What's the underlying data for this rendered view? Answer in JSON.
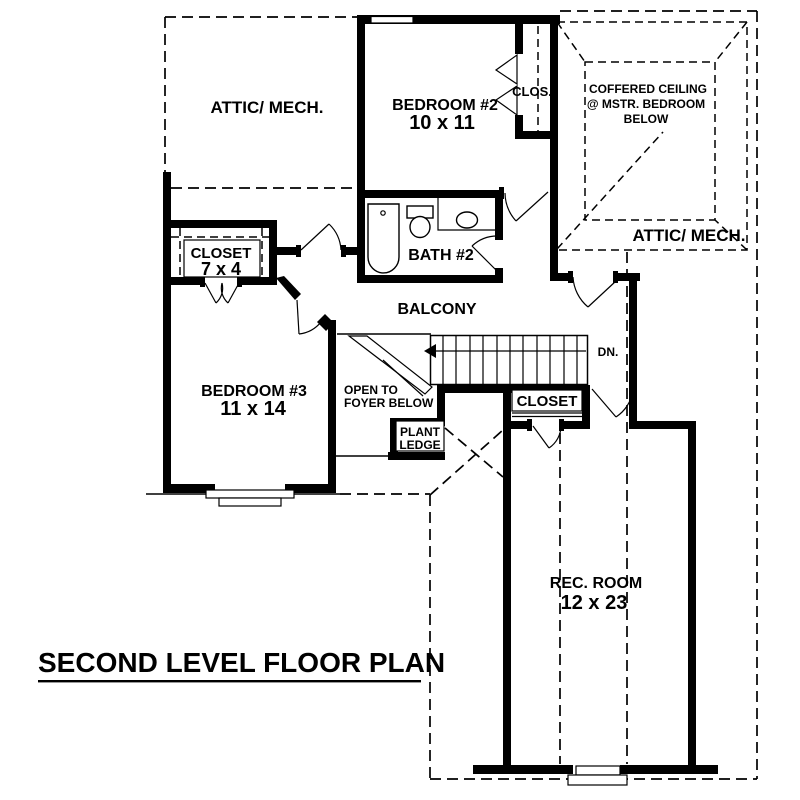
{
  "title": {
    "text": "SECOND LEVEL FLOOR PLAN"
  },
  "labels": {
    "attic_left": "ATTIC/ MECH.",
    "attic_right": "ATTIC/ MECH.",
    "bedroom2_name": "BEDROOM #2",
    "bedroom2_dims": "10 x 11",
    "clos": "CLOS.",
    "coffered_line1": "COFFERED CEILING",
    "coffered_line2": "@ MSTR. BEDROOM",
    "coffered_line3": "BELOW",
    "closet7x4_name": "CLOSET",
    "closet7x4_dims": "7 x 4",
    "bath2": "BATH #2",
    "balcony": "BALCONY",
    "bedroom3_name": "BEDROOM #3",
    "bedroom3_dims": "11 x 14",
    "open_foyer_line1": "OPEN TO",
    "open_foyer_line2": "FOYER BELOW",
    "plant_line1": "PLANT",
    "plant_line2": "LEDGE",
    "dn": "DN.",
    "closet_stairs": "CLOSET",
    "rec_room_name": "REC. ROOM",
    "rec_room_dims": "12 x 23"
  },
  "colors": {
    "ink": "#000000",
    "background": "#ffffff"
  }
}
